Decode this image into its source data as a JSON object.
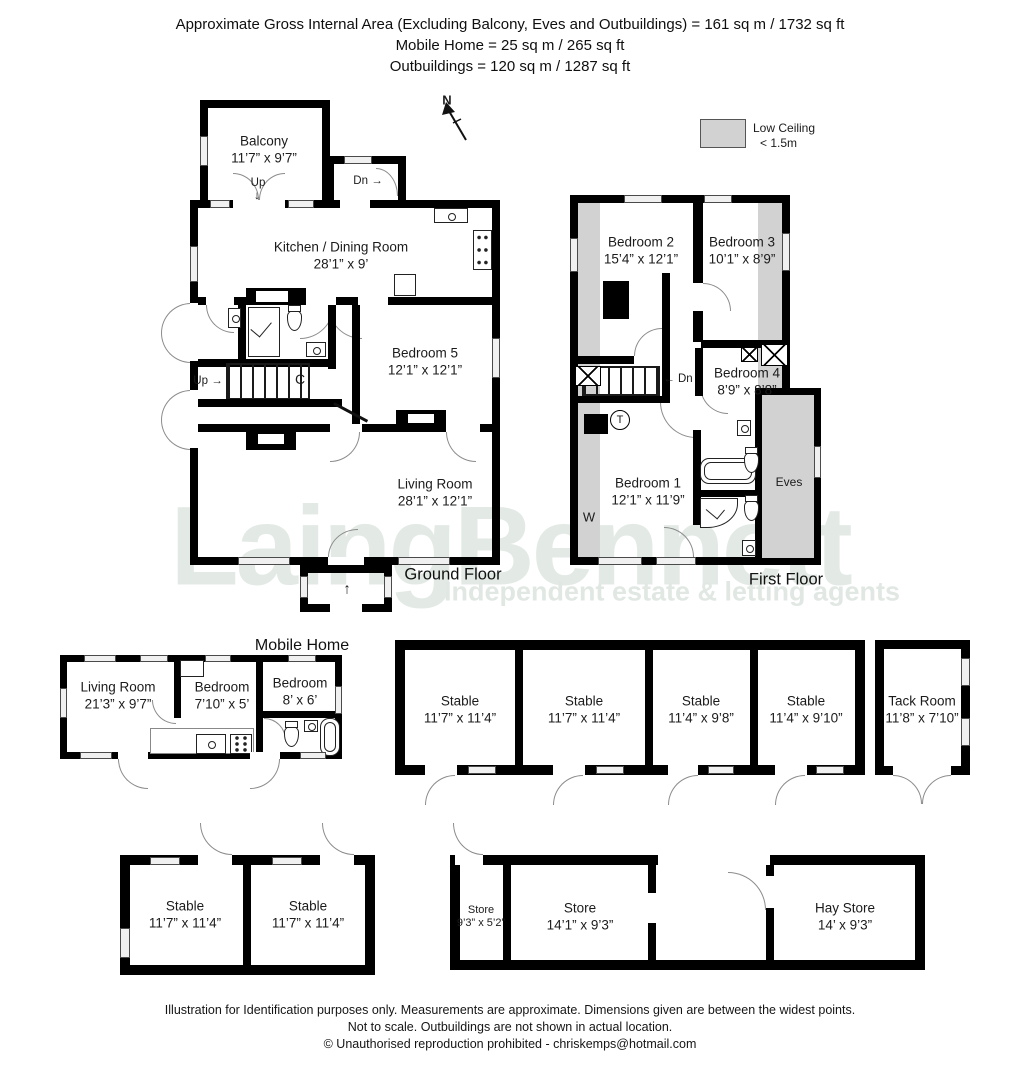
{
  "header": {
    "line1": "Approximate Gross Internal Area (Excluding Balcony, Eves and Outbuildings)  = 161 sq m /  1732 sq ft",
    "line2": "Mobile Home  =  25 sq m / 265 sq ft",
    "line3": "Outbuildings =  120 sq m / 1287 sq ft"
  },
  "compass": {
    "label": "N"
  },
  "legend": {
    "title": "Low Ceiling",
    "subtitle": "< 1.5m",
    "swatch_color": "#d2d2d2"
  },
  "watermark": {
    "brand": "LaingBennett",
    "tagline": "Independent estate & letting agents",
    "color": "#e3eae5"
  },
  "ground_floor": {
    "label": "Ground Floor",
    "balcony": {
      "name": "Balcony",
      "dims": "11’7” x 9’7”"
    },
    "balcony_up": "Up",
    "balcony_up_arrow": "↓",
    "landing_dn": "Dn →",
    "kitchen": {
      "name": "Kitchen / Dining Room",
      "dims": "28’1” x 9’"
    },
    "bedroom5": {
      "name": "Bedroom 5",
      "dims": "12’1” x 12’1”"
    },
    "living": {
      "name": "Living Room",
      "dims": "28’1” x 12’1”"
    },
    "stairs_up": "Up →",
    "cupboard": "C",
    "entrance_arrow": "↑"
  },
  "first_floor": {
    "label": "First Floor",
    "bedroom2": {
      "name": "Bedroom 2",
      "dims": "15’4” x 12’1”"
    },
    "bedroom3": {
      "name": "Bedroom 3",
      "dims": "10’1” x 8’9”"
    },
    "bedroom4": {
      "name": "Bedroom 4",
      "dims": "8’9” x 8’8”"
    },
    "bedroom1": {
      "name": "Bedroom 1",
      "dims": "12’1” x 11’9”"
    },
    "eves": "Eves",
    "wardrobe": "W",
    "tank": "T",
    "stairs_dn": "← Dn"
  },
  "mobile_home": {
    "label": "Mobile Home",
    "living": {
      "name": "Living Room",
      "dims": "21’3” x 9’7”"
    },
    "bedroom_a": {
      "name": "Bedroom",
      "dims": "7’10” x 5’"
    },
    "bedroom_b": {
      "name": "Bedroom",
      "dims": "8’ x 6’"
    }
  },
  "outbuildings": {
    "stables_row": [
      {
        "name": "Stable",
        "dims": "11’7” x 11’4”"
      },
      {
        "name": "Stable",
        "dims": "11’7” x 11’4”"
      },
      {
        "name": "Stable",
        "dims": "11’4” x 9’8”"
      },
      {
        "name": "Stable",
        "dims": "11’4” x 9’10”"
      }
    ],
    "tack_room": {
      "name": "Tack Room",
      "dims": "11’8” x 7’10”"
    },
    "stables_pair": [
      {
        "name": "Stable",
        "dims": "11’7” x 11’4”"
      },
      {
        "name": "Stable",
        "dims": "11’7” x 11’4”"
      }
    ],
    "store_small": {
      "name": "Store",
      "dims": "9’3” x 5’2”"
    },
    "store": {
      "name": "Store",
      "dims": "14’1” x 9’3”"
    },
    "hay_store": {
      "name": "Hay Store",
      "dims": "14’ x 9’3”"
    }
  },
  "footer": {
    "line1": "Illustration for Identification purposes only.  Measurements are approximate. Dimensions given are between the widest points.",
    "line2": "Not to scale.  Outbuildings are not shown in actual location.",
    "line3": "© Unauthorised reproduction prohibited  -  chriskemps@hotmail.com"
  }
}
